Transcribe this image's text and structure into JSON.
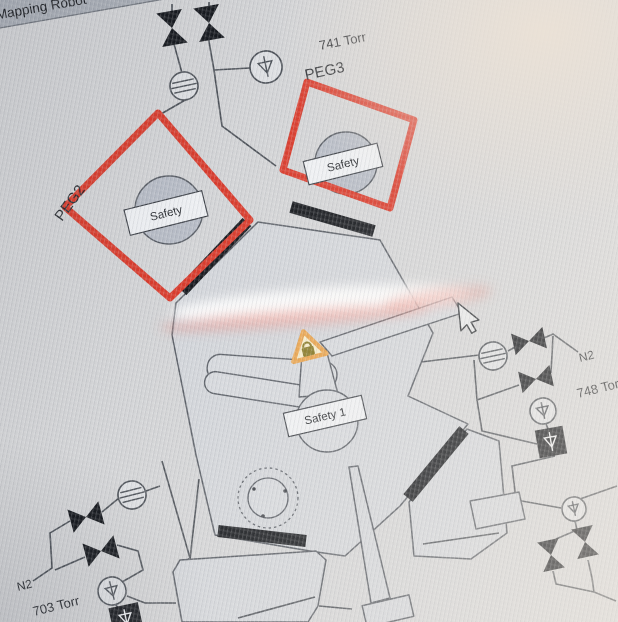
{
  "window": {
    "title": "Mapping Robot"
  },
  "chambers": {
    "peg2": {
      "label": "PEG2",
      "badge": "Safety"
    },
    "peg3": {
      "label": "PEG3",
      "badge": "Safety"
    },
    "robot": {
      "badge": "Safety 1"
    }
  },
  "readings": {
    "top": "741 Torr",
    "right": "748 Torr",
    "bottom_left": "703 Torr"
  },
  "gas_lines": {
    "right": "N2",
    "bottom_left": "N2"
  },
  "colors": {
    "alarm_red": "#d93b2c",
    "warning_orange": "#e8a24b",
    "line_dark": "#4c5158",
    "chamber_fill": "#d2d5da",
    "disc_fill": "#b7bcc6",
    "valve_black": "#15181d",
    "background": "#d3d4d6",
    "tag_fill": "#eef0f3"
  }
}
